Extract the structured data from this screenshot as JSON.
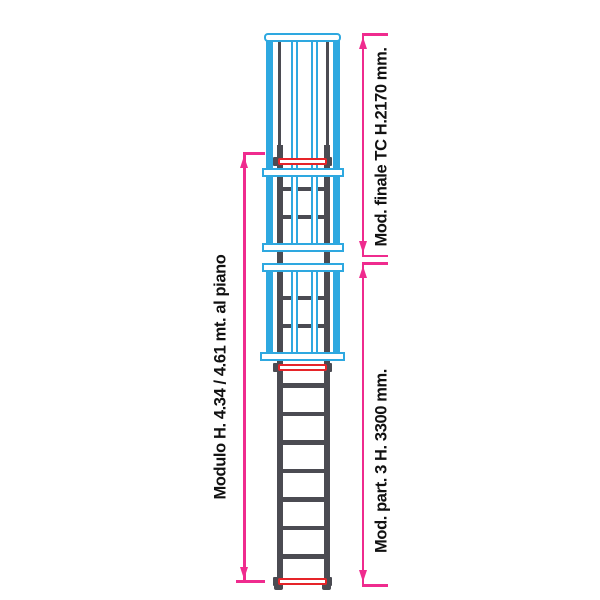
{
  "labels": {
    "left_dimension": "Modulo H. 4.34 / 4.61 mt. al piano",
    "right_top_dimension": "Mod. finale TC  H.2170 mm.",
    "right_bottom_dimension": "Mod. part. 3  H. 3300 mm."
  },
  "colors": {
    "cage": "#2EA8E0",
    "ladder": "#4B4B52",
    "highlight_rung": "#E62429",
    "dimension": "#EF2B8E",
    "text": "#111111",
    "background": "#FFFFFF"
  }
}
